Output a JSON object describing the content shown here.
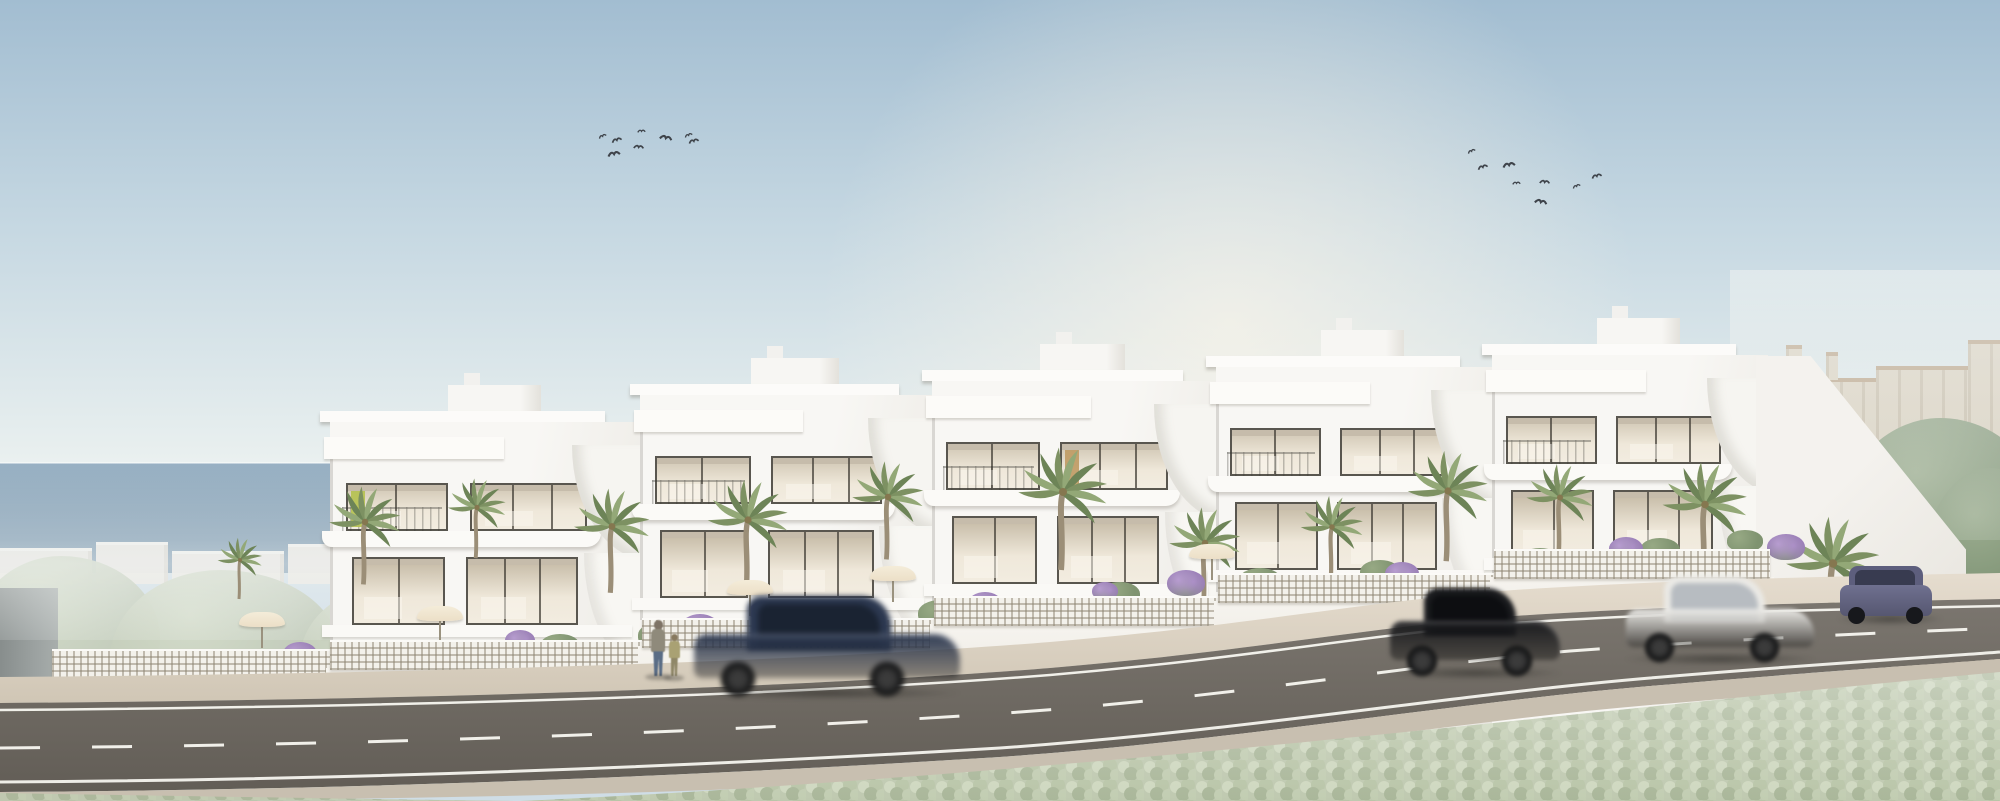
{
  "scene": {
    "type": "architectural-rendering",
    "subject": "row-of-five-white-seaside-townhouses-with-road",
    "width": 2000,
    "height": 801
  },
  "palette": {
    "sky_top": "#a2bdd1",
    "sky_mid": "#c6d8e2",
    "sky_horizon": "#eef3f1",
    "sun_glow": "#fff7e9",
    "sea_top": "#92acc0",
    "sea_bottom": "#7492aa",
    "facade": "#f8f7f4",
    "facade_shade": "#e6e4de",
    "glass_top": "#cfc5b2",
    "glass_bottom": "#efe8da",
    "frame": "#59564f",
    "accent_lime": "#b5c14f",
    "accent_wood": "#bf9a63",
    "fence": "#f3f1eb",
    "fence_grid": "#8d8472",
    "wall": "#f6f4ef",
    "sidewalk": "#e0d7c8",
    "road": "#6f6a63",
    "road_line": "#f1f0ea",
    "curb": "#c8bfb0",
    "verge": "#bfc9b0",
    "coast_building": "#eae7e1",
    "coast_tree": "#c4cdbb",
    "bg_building": "#d9d0bf",
    "bg_roof": "#b79f83",
    "bg_tree": "#84987a",
    "rock": "#8a8172",
    "palm_frond_a": "#7d9162",
    "palm_frond_b": "#93a877",
    "palm_frond_c": "#6d8457",
    "palm_trunk": "#9b8e77",
    "shrub_purple_a": "#b79cd0",
    "shrub_purple_b": "#8f74ad",
    "bush_green_a": "#97a984",
    "bush_green_b": "#7f9370",
    "parasol": "#ecdfc7",
    "bird": "#3f444b"
  },
  "development": {
    "units": [
      {
        "x": 330,
        "w": 310,
        "t": 385
      },
      {
        "x": 640,
        "w": 292,
        "t": 358
      },
      {
        "x": 932,
        "w": 284,
        "t": 344
      },
      {
        "x": 1216,
        "w": 276,
        "t": 330
      },
      {
        "x": 1492,
        "w": 276,
        "t": 318
      }
    ],
    "accents": [
      {
        "unit": 0,
        "window": "A",
        "color": "#b5c14f"
      },
      {
        "unit": 2,
        "window": "B",
        "color": "#bf9a63"
      }
    ]
  },
  "fence_segments": [
    {
      "x": 52,
      "w": 280,
      "top": 649
    },
    {
      "x": 330,
      "w": 312,
      "top": 640
    },
    {
      "x": 642,
      "w": 292,
      "top": 618
    },
    {
      "x": 934,
      "w": 284,
      "top": 596
    },
    {
      "x": 1218,
      "w": 276,
      "top": 573
    },
    {
      "x": 1494,
      "w": 276,
      "top": 549
    }
  ],
  "coast_buildings": [
    [
      0,
      548,
      92,
      36
    ],
    [
      96,
      542,
      72,
      42
    ],
    [
      172,
      551,
      112,
      32
    ],
    [
      288,
      544,
      82,
      40
    ],
    [
      372,
      539,
      62,
      44
    ],
    [
      436,
      549,
      122,
      32
    ]
  ],
  "trees_left": [
    [
      -30,
      556,
      190,
      150
    ],
    [
      110,
      570,
      230,
      150
    ],
    [
      300,
      582,
      210,
      130
    ],
    [
      430,
      598,
      170,
      115
    ]
  ],
  "bg_right_buildings": [
    [
      1752,
      378,
      128,
      95
    ],
    [
      1876,
      366,
      96,
      108
    ],
    [
      1968,
      340,
      32,
      132
    ],
    [
      1786,
      345,
      16,
      36
    ],
    [
      1826,
      352,
      12,
      28
    ]
  ],
  "trees_right": [
    [
      1512,
      408,
      215,
      180
    ],
    [
      1655,
      428,
      245,
      175
    ],
    [
      1838,
      418,
      205,
      195
    ],
    [
      1925,
      468,
      130,
      165
    ]
  ],
  "rock": [
    1940,
    518,
    72,
    115
  ],
  "palms": [
    [
      240,
      560,
      0.5
    ],
    [
      365,
      522,
      0.8
    ],
    [
      477,
      507,
      0.65
    ],
    [
      612,
      526,
      0.85
    ],
    [
      748,
      520,
      0.9
    ],
    [
      888,
      497,
      0.8
    ],
    [
      1063,
      492,
      1.0
    ],
    [
      1205,
      543,
      0.8
    ],
    [
      1332,
      527,
      0.7
    ],
    [
      1448,
      491,
      0.9
    ],
    [
      1560,
      497,
      0.75
    ],
    [
      1705,
      504,
      0.95
    ],
    [
      1833,
      563,
      1.05
    ]
  ],
  "purple_shrubs": [
    [
      300,
      642,
      0.9
    ],
    [
      520,
      630,
      0.8
    ],
    [
      700,
      614,
      1.0
    ],
    [
      762,
      602,
      0.7
    ],
    [
      985,
      592,
      0.9
    ],
    [
      1105,
      582,
      0.7
    ],
    [
      1186,
      570,
      1.0
    ],
    [
      1402,
      562,
      0.9
    ],
    [
      1516,
      550,
      0.8
    ],
    [
      1626,
      537,
      0.9
    ],
    [
      1786,
      534,
      1.0
    ],
    [
      1088,
      600,
      0.8
    ]
  ],
  "green_bushes": [
    [
      420,
      646,
      1.0
    ],
    [
      560,
      634,
      0.9
    ],
    [
      660,
      622,
      1.0
    ],
    [
      840,
      606,
      0.9
    ],
    [
      940,
      600,
      1.0
    ],
    [
      1120,
      582,
      0.9
    ],
    [
      1260,
      568,
      1.0
    ],
    [
      1380,
      560,
      0.9
    ],
    [
      1540,
      548,
      1.0
    ],
    [
      1660,
      538,
      0.9
    ],
    [
      215,
      652,
      0.8
    ],
    [
      1745,
      530,
      0.8
    ]
  ],
  "parasols": [
    [
      262,
      612
    ],
    [
      440,
      606
    ],
    [
      750,
      580
    ],
    [
      893,
      566
    ],
    [
      1212,
      544
    ]
  ],
  "cars": [
    {
      "id": "car-navy-sedan",
      "style": "moving",
      "color": "#2c3850",
      "glass": "#1a2332",
      "x": 694,
      "y": 596,
      "w": 266,
      "h": 100,
      "blur": 2.6
    },
    {
      "id": "car-black-suv",
      "style": "moving",
      "color": "#1a1b1e",
      "glass": "#0d0e11",
      "x": 1390,
      "y": 588,
      "w": 170,
      "h": 88,
      "blur": 2.2
    },
    {
      "id": "car-white-sedan",
      "style": "moving",
      "color": "#eae9e5",
      "glass": "#b7bcc1",
      "x": 1626,
      "y": 576,
      "w": 188,
      "h": 86,
      "blur": 2.2
    },
    {
      "id": "car-parked-violet",
      "style": "parked",
      "color": "#6f7090",
      "roof": "#5d5e7d",
      "glass": "#383b50",
      "x": 1840,
      "y": 566,
      "w": 100,
      "h": 56,
      "blur": 0
    }
  ],
  "pedestrians": [
    {
      "id": "adult-walker",
      "x": 650,
      "y": 620,
      "h": 56,
      "top": "#8f8a7b",
      "legs": "#5a6d86",
      "head": "#7e7366"
    },
    {
      "id": "child-walker",
      "x": 668,
      "y": 634,
      "h": 42,
      "top": "#a9a173",
      "legs": "#8f8768",
      "head": "#87795f"
    }
  ],
  "birds": {
    "flock_left": [
      [
        598,
        133
      ],
      [
        611,
        136
      ],
      [
        607,
        149
      ],
      [
        637,
        128
      ],
      [
        633,
        143
      ],
      [
        659,
        133
      ],
      [
        684,
        132
      ],
      [
        688,
        137
      ]
    ],
    "flock_right": [
      [
        1467,
        148
      ],
      [
        1477,
        163
      ],
      [
        1502,
        160
      ],
      [
        1512,
        180
      ],
      [
        1539,
        178
      ],
      [
        1534,
        197
      ],
      [
        1572,
        183
      ],
      [
        1591,
        172
      ]
    ]
  }
}
